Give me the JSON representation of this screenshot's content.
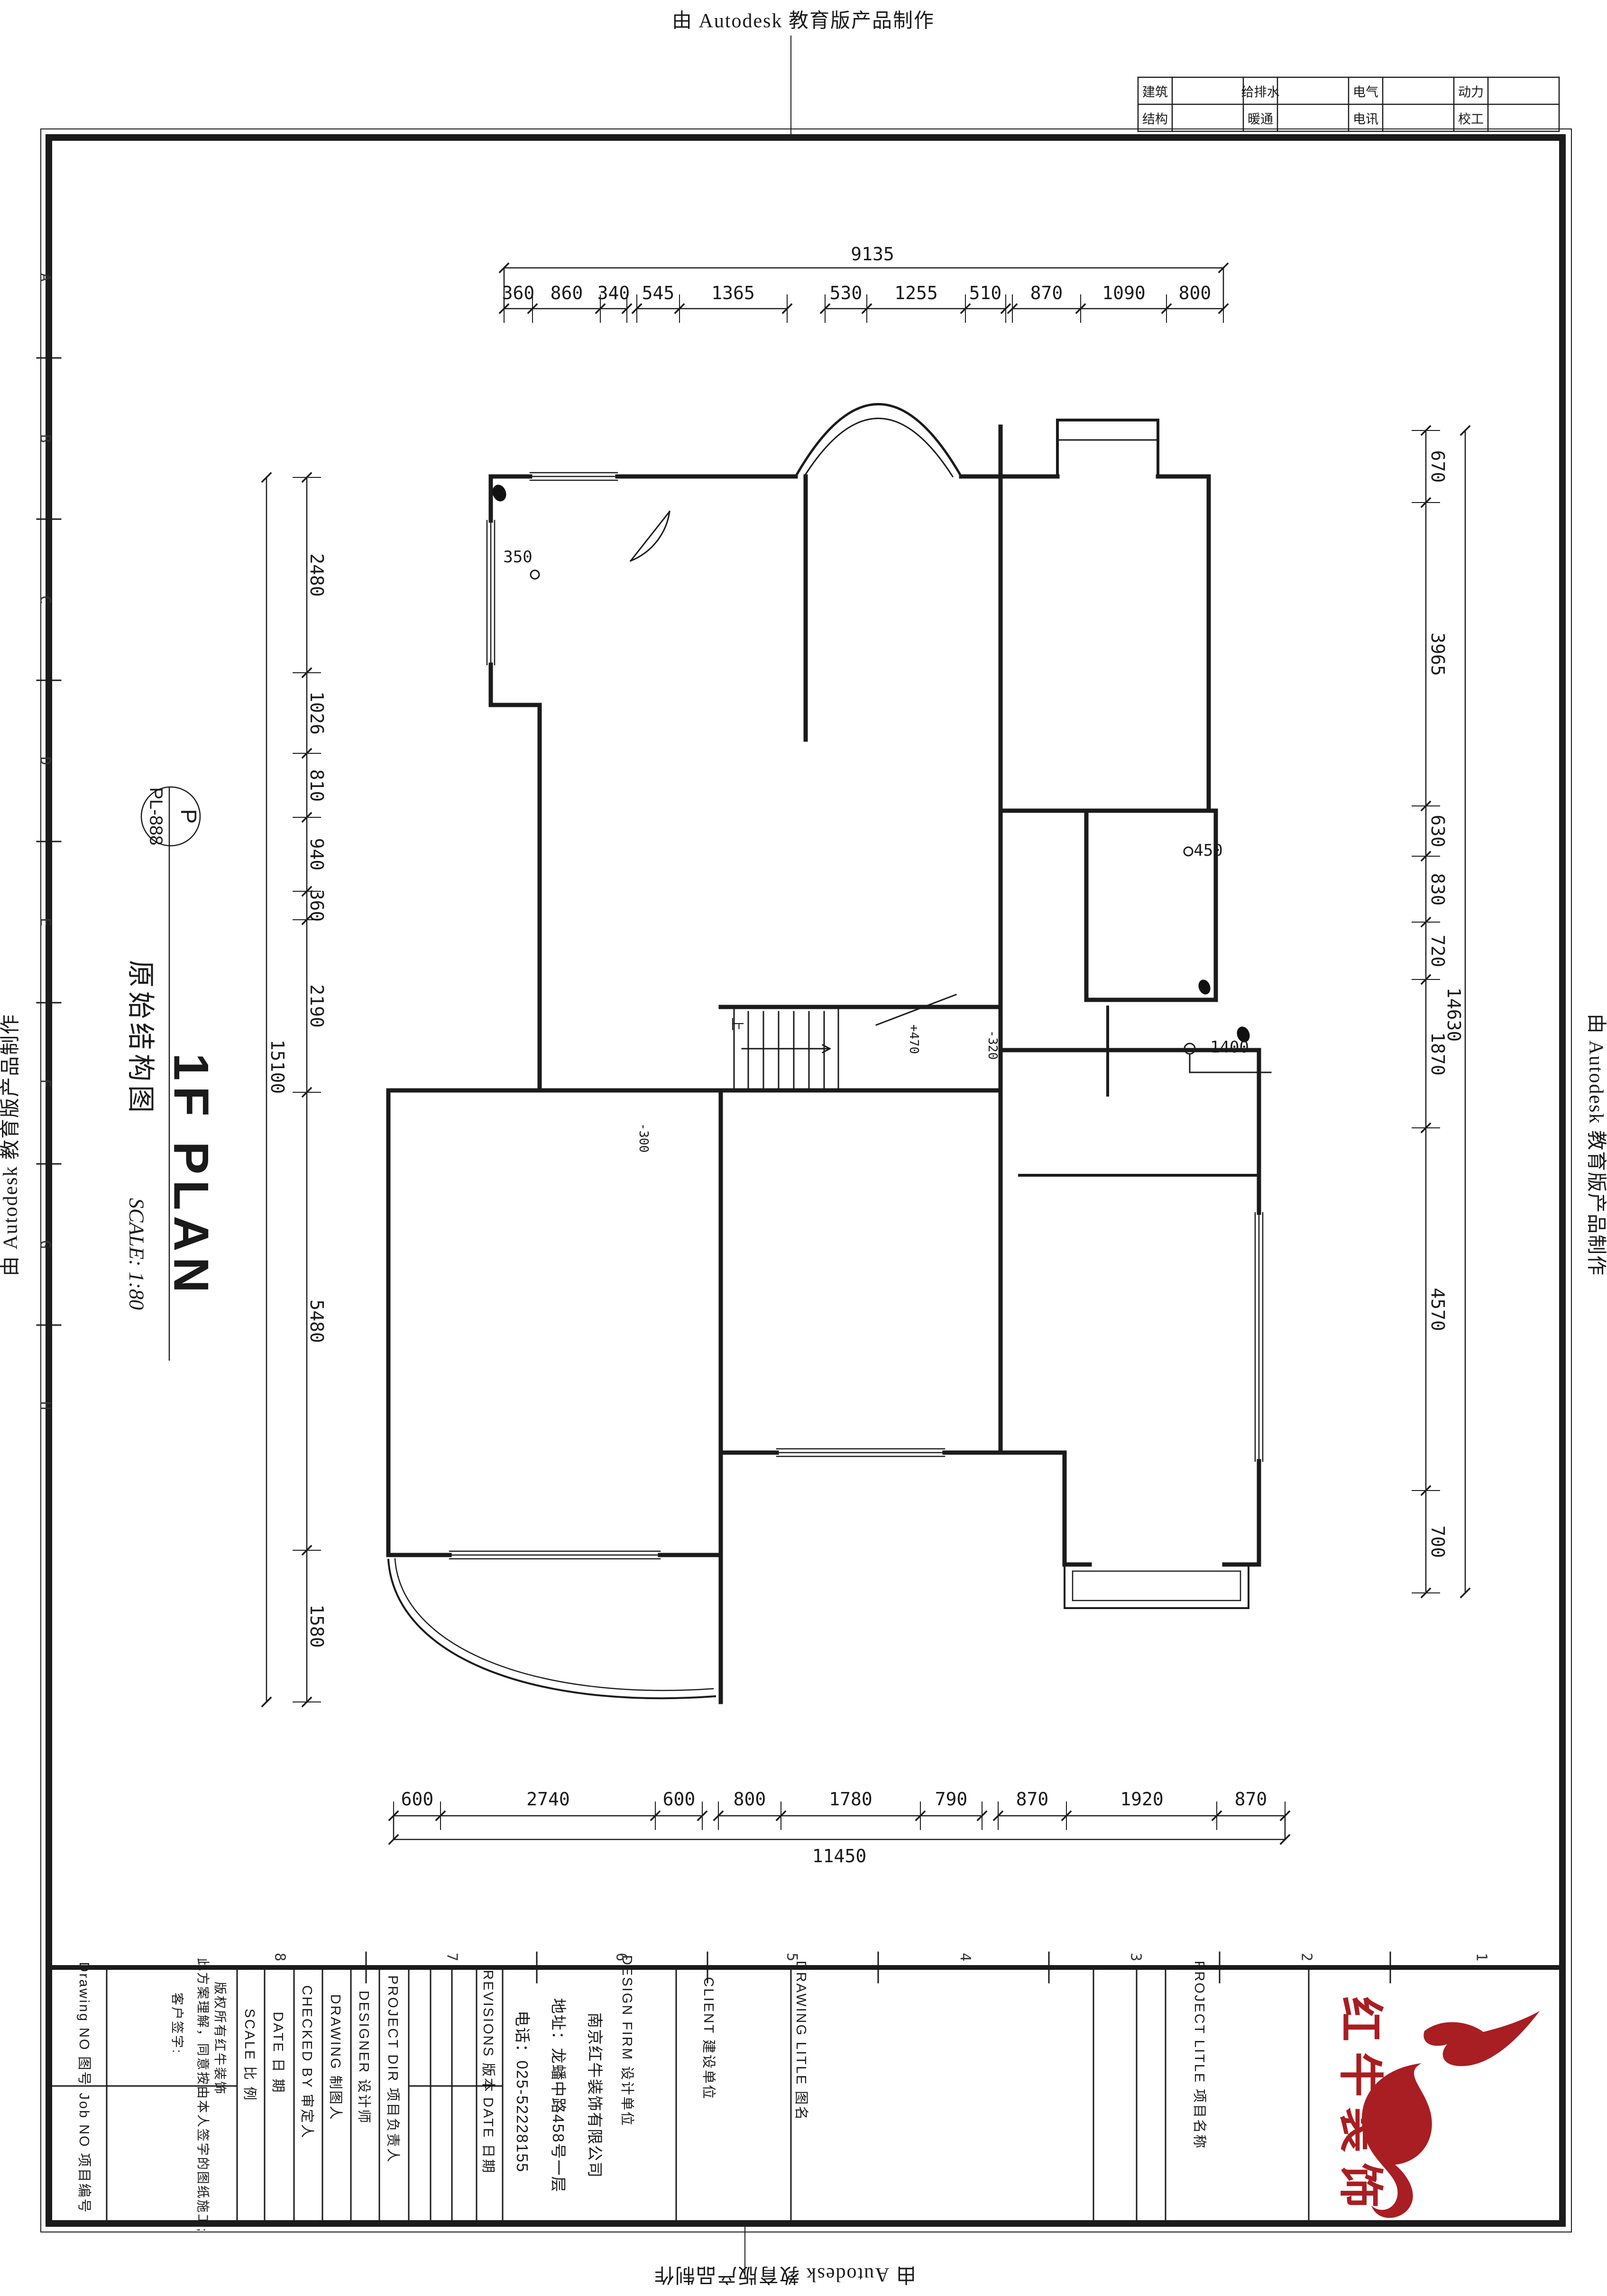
{
  "edu_stamp": "由 Autodesk 教育版产品制作",
  "discipline_table": {
    "rows": [
      [
        "建筑",
        "给排水",
        "电气",
        "动力"
      ],
      [
        "结构",
        "暖通",
        "电讯",
        "校工"
      ]
    ]
  },
  "grid_refs": {
    "bottom": [
      "8",
      "7",
      "6",
      "5",
      "4",
      "3",
      "2",
      "1"
    ],
    "left": [
      "A",
      "B",
      "C",
      "D",
      "E",
      "F",
      "G",
      "H"
    ]
  },
  "dims": {
    "top": {
      "total": "9135",
      "segments": [
        "360",
        "860",
        "340",
        "545",
        "1365",
        "530",
        "1255",
        "510",
        "870",
        "1090",
        "800"
      ]
    },
    "bottom": {
      "total": "11450",
      "segments": [
        "600",
        "2740",
        "600",
        "800",
        "1780",
        "790",
        "870",
        "1920",
        "870"
      ]
    },
    "left": {
      "total": "15100",
      "segments": [
        "2480",
        "1026",
        "810",
        "940",
        "360",
        "2190",
        "5480",
        "1580"
      ]
    },
    "right": {
      "total": "14630",
      "segments": [
        "670",
        "3965",
        "630",
        "830",
        "720",
        "1870",
        "4570",
        "700"
      ]
    }
  },
  "plan_labels": {
    "d350": "350",
    "d450": "450",
    "d1400": "1400",
    "lvl_m300": "-300",
    "lvl_m320": "-320",
    "lvl_p470": "+470",
    "stair_up": "上"
  },
  "titles": {
    "bubble_top": "P",
    "bubble_bottom": "PL-888",
    "drawing_name": "原始结构图",
    "plan_title": "1F PLAN",
    "scale_note": "SCALE: 1:80"
  },
  "title_block": {
    "drawing_no": "Drawing NO 图号",
    "job_no": "Job NO 项目编号",
    "disclaimer_line1": "版权所有红牛装饰",
    "disclaimer_line2": "此方案理解，同意按由本人签字的图纸施工;",
    "disclaimer_line3": "客户签字:",
    "scale": "SCALE  比 例",
    "date1": "DATE  日 期",
    "checked_by": "CHECKED BY  审定人",
    "drawing": "DRAWING  制图人",
    "designer": "DESIGNER  设计师",
    "project_dir": "PROJECT DIR  项目负责人",
    "revisions": "REVISIONS  版本",
    "date2": "DATE 日期",
    "design_firm": "DESIGN FIRM  设计单位",
    "company": "南京红牛装饰有限公司",
    "address": "地址：龙蟠中路458号一层",
    "phone": "电话：025-52228155",
    "client": "CLIENT  建设单位",
    "drawing_title": "DRAWING LITLE  图名",
    "project_title": "PROJECT LITLE  项目名称",
    "logo_text": "红牛装饰",
    "logo_color": "#a81e22"
  }
}
